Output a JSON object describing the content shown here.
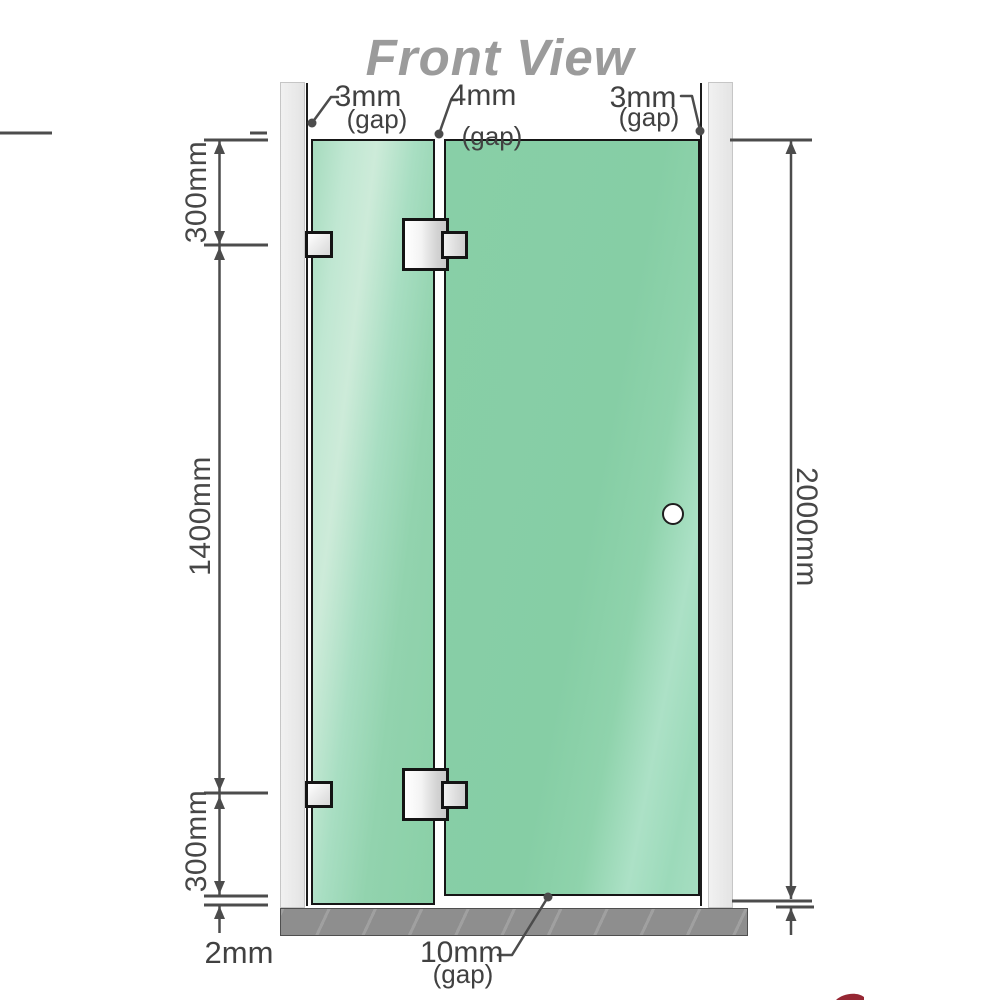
{
  "title": "Front View",
  "gaps": {
    "top_left": {
      "value": "3mm",
      "note": "(gap)"
    },
    "top_middle": {
      "value": "4mm",
      "note": "(gap)"
    },
    "top_right": {
      "value": "3mm",
      "note": "(gap)"
    },
    "bottom": {
      "value": "10mm",
      "note": "(gap)"
    }
  },
  "dimensions": {
    "left_top": "300mm",
    "left_middle": "1400mm",
    "left_bottom": "300mm",
    "floor_clearance": "2mm",
    "right_total_height": "2000mm"
  },
  "colors": {
    "glass": "#8fd2ac",
    "glass_hi": "#c7ead6",
    "wall": "#ececec",
    "floor": "#8e8e8e",
    "line": "#4c4c4c",
    "panel_border": "#161616",
    "title": "#9b9b9b",
    "accent_red": "#8b0f1d"
  }
}
